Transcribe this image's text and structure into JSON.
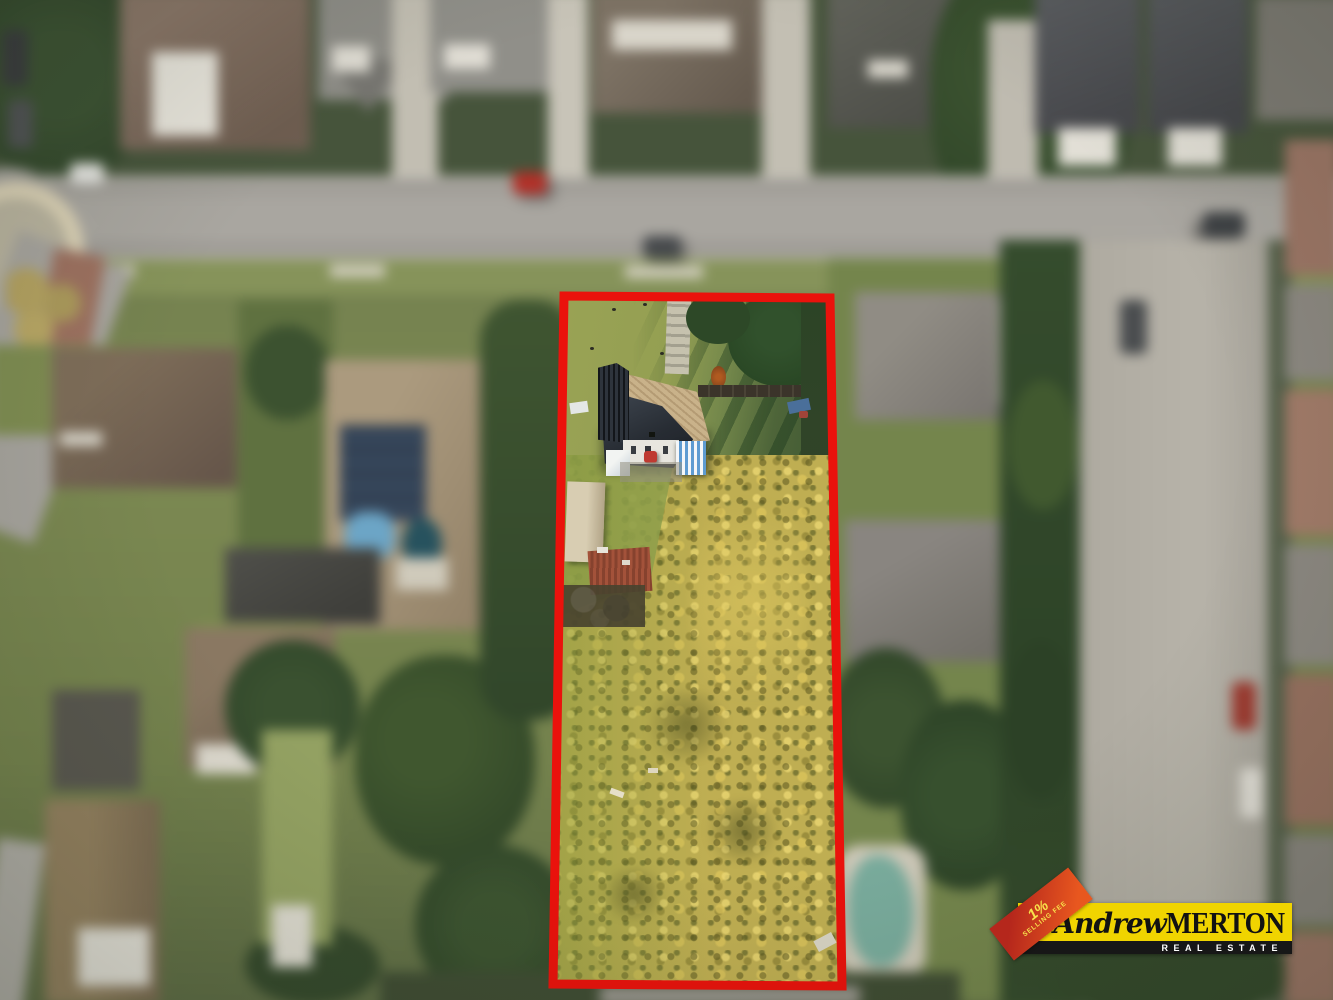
{
  "image": {
    "alt": "Aerial drone photograph of a suburban residential block; a long narrow vacant property with a house at the street end and overgrown grass behind is outlined in red; surrounding houses, street and yards are blurred (tilt-shift)."
  },
  "boundary": {
    "color": "#ea120c"
  },
  "logo": {
    "badge": {
      "line1": "1%",
      "line2": "SELLING FEE"
    },
    "name": {
      "script": "Andrew",
      "caps": "MERTON"
    },
    "subtitle": "REAL ESTATE",
    "colors": {
      "background": "#f0d400",
      "bar": "#171717",
      "badge_top": "#b5271c",
      "badge_bottom": "#e8571f",
      "text": "#121212",
      "subtitle_text": "#ffffff",
      "badge_text": "#f8e24b"
    }
  }
}
